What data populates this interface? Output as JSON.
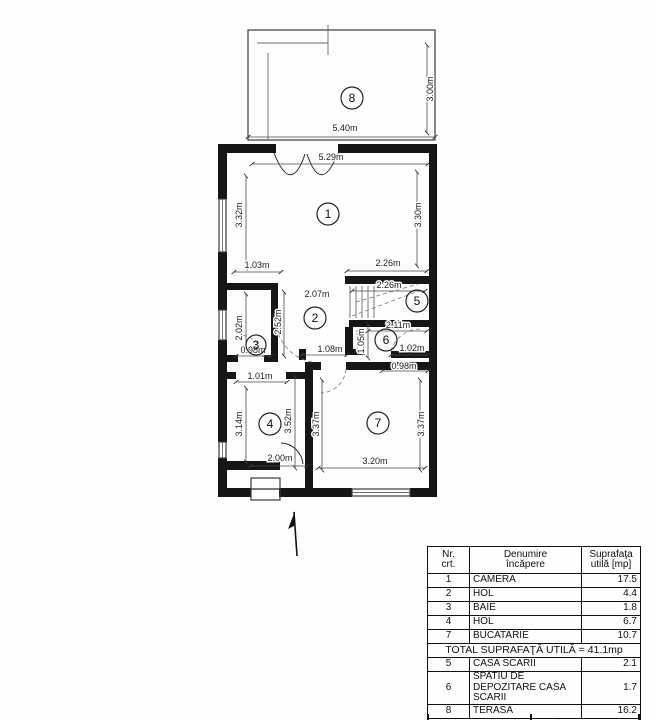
{
  "plan": {
    "room_numbers": [
      "1",
      "2",
      "3",
      "4",
      "5",
      "6",
      "7",
      "8"
    ],
    "dims": [
      "5.40m",
      "3.00m",
      "5.29m",
      "3.32m",
      "3.30m",
      "1.03m",
      "2.26m",
      "2.26m",
      "2.07m",
      "2.52m",
      "2.02m",
      "2.11m",
      "1.05m",
      "0.98m",
      "1.08m",
      "1.02m",
      "0.98m",
      "1.01m",
      "3.14m",
      "3.52m",
      "3.37m",
      "3.37m",
      "2.00m",
      "3.20m"
    ],
    "line_color": "#161616"
  },
  "table": {
    "header": {
      "nr1": "Nr.",
      "nr2": "crt.",
      "den1": "Denumire",
      "den2": "încăpere",
      "sup1": "Suprafaţa",
      "sup2": "utilă [mp]"
    },
    "rows": [
      {
        "nr": "1",
        "name": "CAMERA",
        "area": "17.5"
      },
      {
        "nr": "2",
        "name": "HOL",
        "area": "4.4"
      },
      {
        "nr": "3",
        "name": "BAIE",
        "area": "1.8"
      },
      {
        "nr": "4",
        "name": "HOL",
        "area": "6.7"
      },
      {
        "nr": "7",
        "name": "BUCATARIE",
        "area": "10.7"
      }
    ],
    "total_util": "TOTAL SUPRAFAŢĂ UTILĂ = 41.1mp",
    "rows2": [
      {
        "nr": "5",
        "name": "CASA SCARII",
        "area": "2.1"
      },
      {
        "nr": "6",
        "name": "SPATIU DE DEPOZITARE CASA SCARII",
        "area": "1.7"
      },
      {
        "nr": "8",
        "name": "TERASA",
        "area": "16.2"
      }
    ],
    "total": "SUPRAFAŢĂ TOTALĂ = 61.1 mp"
  }
}
